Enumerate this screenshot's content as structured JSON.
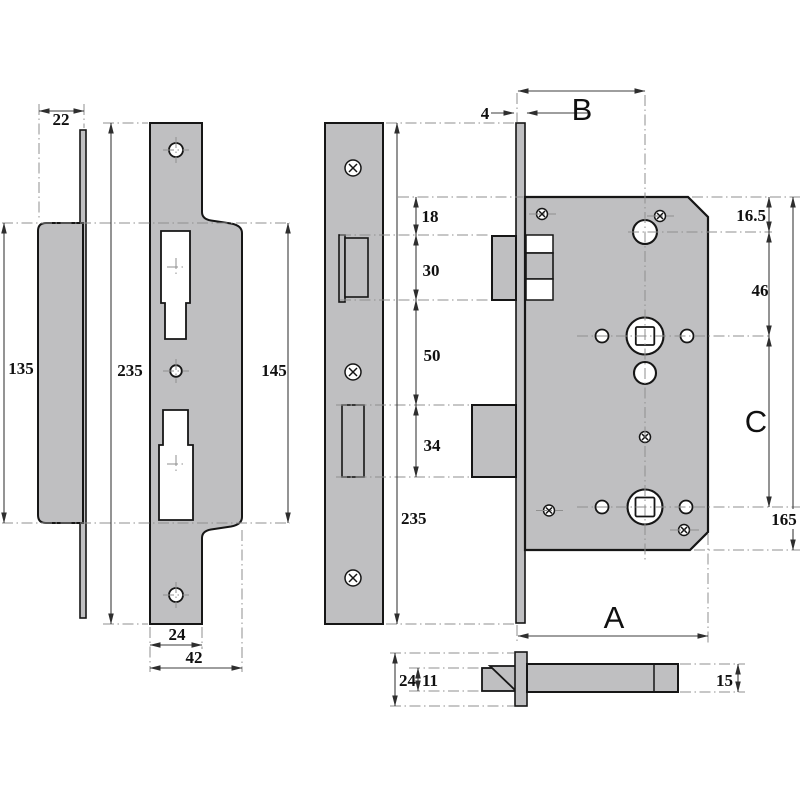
{
  "drawing": {
    "type": "technical-dimension-drawing",
    "subject": "bathroom mortice lock case with strike plate, faceplate and plan views",
    "colors": {
      "metal_fill": "#bfbfc1",
      "outline": "#161616",
      "dimension_line": "#3c3c3c",
      "centerline": "#8f8f8f",
      "background": "#ffffff"
    },
    "dims": {
      "strike_side_width": "22",
      "strike_side_body_height": "135",
      "strike_front_total_height": "235",
      "strike_front_wide_height": "145",
      "strike_front_narrow_width": "24",
      "strike_front_full_width": "42",
      "faceplate_total_height": "235",
      "case_top_to_latch": "18",
      "latch_height": "30",
      "latch_to_deadbolt": "50",
      "deadbolt_height": "34",
      "faceplate_thickness": "4",
      "backset": "B",
      "top_to_cylinder_center": "16.5",
      "cylinder_to_spindle": "46",
      "spindle_to_follower": "C",
      "case_height": "165",
      "case_depth": "A",
      "plan_faceplate_width": "24",
      "plan_latch_width": "11",
      "plan_case_thickness": "15"
    }
  }
}
